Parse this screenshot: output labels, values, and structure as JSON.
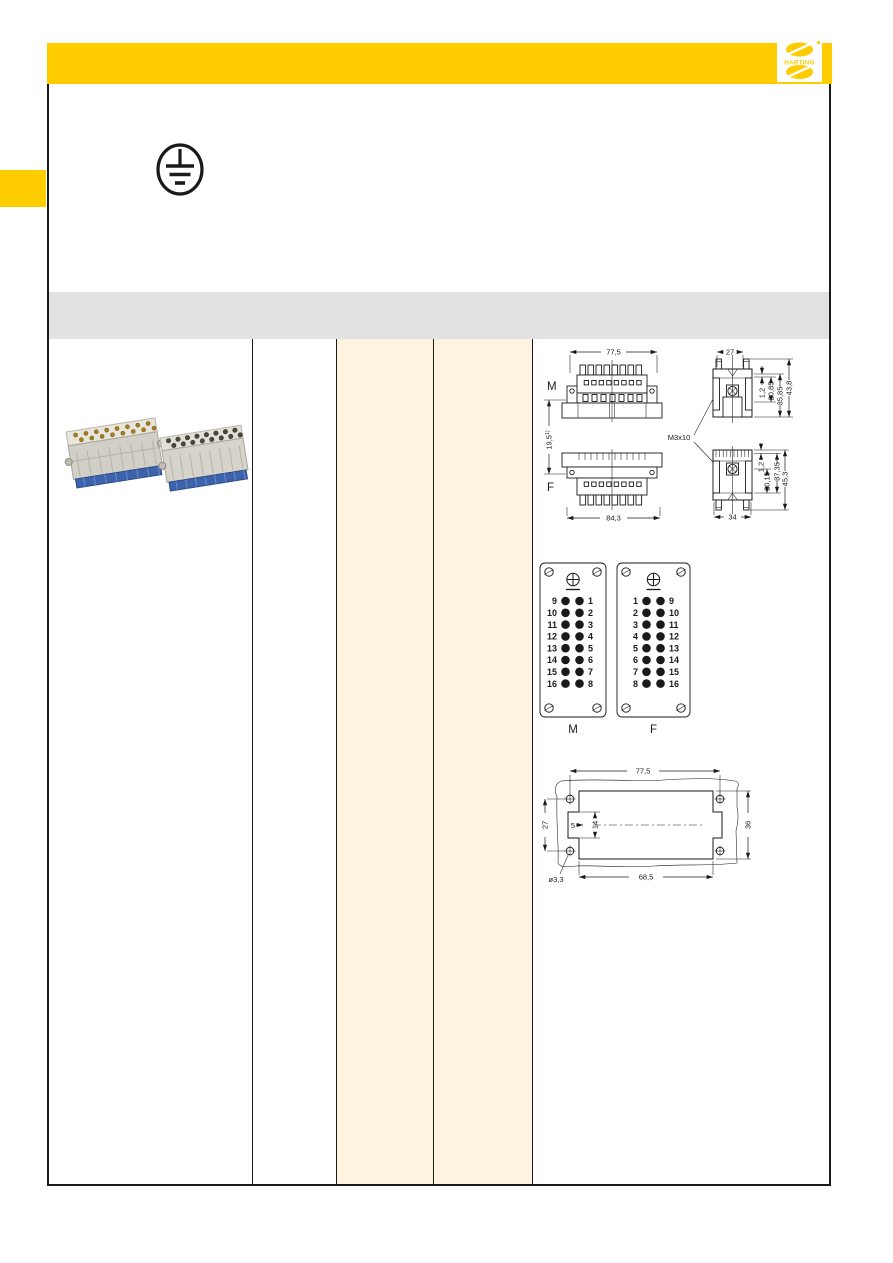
{
  "theme": {
    "brand_yellow": "#FFCC00",
    "highlight_cream": "#FDF3DE",
    "band_gray": "#E2E2E2",
    "ink": "#1A1A1A",
    "terminal_blue": "#3D63AD"
  },
  "icons": {
    "protective_earth": "protective-earth-symbol",
    "logo_mark": "harting-logo-mark"
  },
  "header": {
    "logo_text": "HARTING",
    "logo_registered_mark": "®"
  },
  "insert_drawing": {
    "label_m": "M",
    "label_f": "F",
    "screw_label": "M3x10",
    "dim_m_width": "77,5",
    "dim_f_width": "84,3",
    "dim_side_top_width": "27",
    "dim_side_bottom_width": "34",
    "dim_offset": "19,5",
    "dim_offset_note": "1)",
    "dims_side_top": [
      "1,2",
      "20,85",
      "35,85",
      "43,8"
    ],
    "dims_side_bottom": [
      "1,2",
      "20,15",
      "37,35",
      "45,3"
    ]
  },
  "contact_faces": {
    "m": {
      "label": "M",
      "rows": [
        [
          "9",
          "1"
        ],
        [
          "10",
          "2"
        ],
        [
          "11",
          "3"
        ],
        [
          "12",
          "4"
        ],
        [
          "13",
          "5"
        ],
        [
          "14",
          "6"
        ],
        [
          "15",
          "7"
        ],
        [
          "16",
          "8"
        ]
      ]
    },
    "f": {
      "label": "F",
      "rows": [
        [
          "1",
          "9"
        ],
        [
          "2",
          "10"
        ],
        [
          "3",
          "11"
        ],
        [
          "4",
          "12"
        ],
        [
          "5",
          "13"
        ],
        [
          "6",
          "14"
        ],
        [
          "7",
          "15"
        ],
        [
          "8",
          "16"
        ]
      ]
    }
  },
  "panel_cutout": {
    "dim_top": "77,5",
    "dim_left": "27",
    "dim_right": "36",
    "dim_bottom": "68,5",
    "dim_notch_depth": "5",
    "dim_notch_height": "14",
    "dim_hole": "ø3,3"
  }
}
